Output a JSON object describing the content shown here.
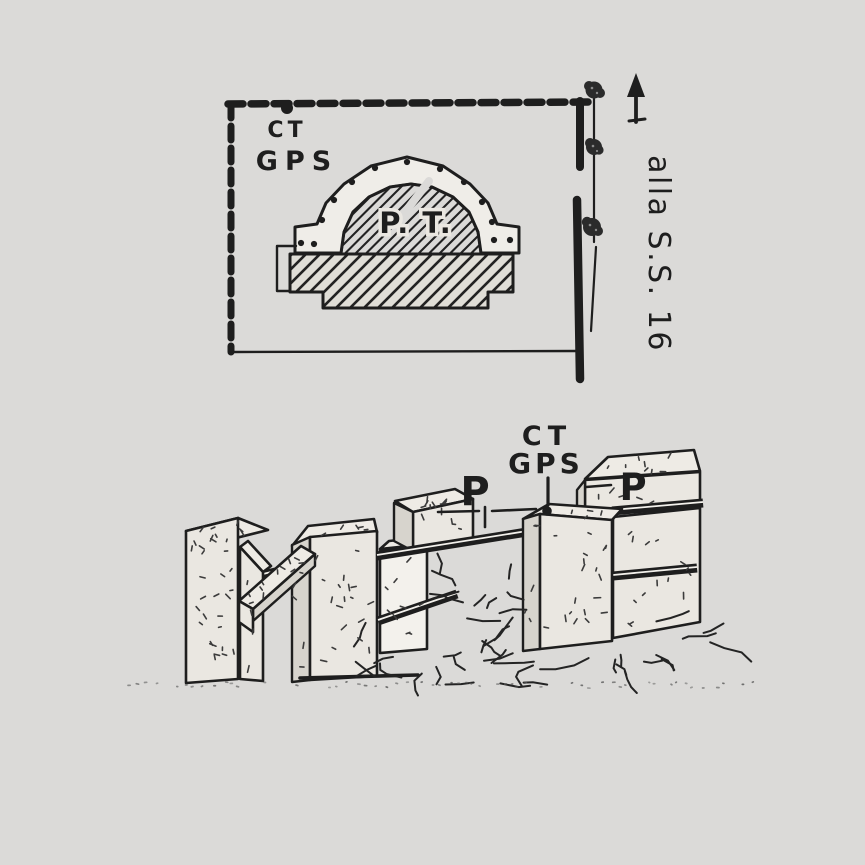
{
  "plan": {
    "survey_point": {
      "line1": "CT",
      "line2": "GPS"
    },
    "monument_label": "P. T.",
    "road_label": "alla S.S. 16"
  },
  "iso": {
    "left_pier_label": "P",
    "survey_point": {
      "line1": "CT",
      "line2": "GPS"
    },
    "right_pier_label": "P"
  },
  "colors": {
    "background": "#dbdad8",
    "ink": "#1e1e1e",
    "concrete_face": "#eae7e1",
    "concrete_top": "#eeebe5",
    "concrete_bright": "#f3f1ec",
    "concrete_shade": "#d7d4cd",
    "stipple": "#3c3c3c",
    "band_fill": "#efede8"
  }
}
